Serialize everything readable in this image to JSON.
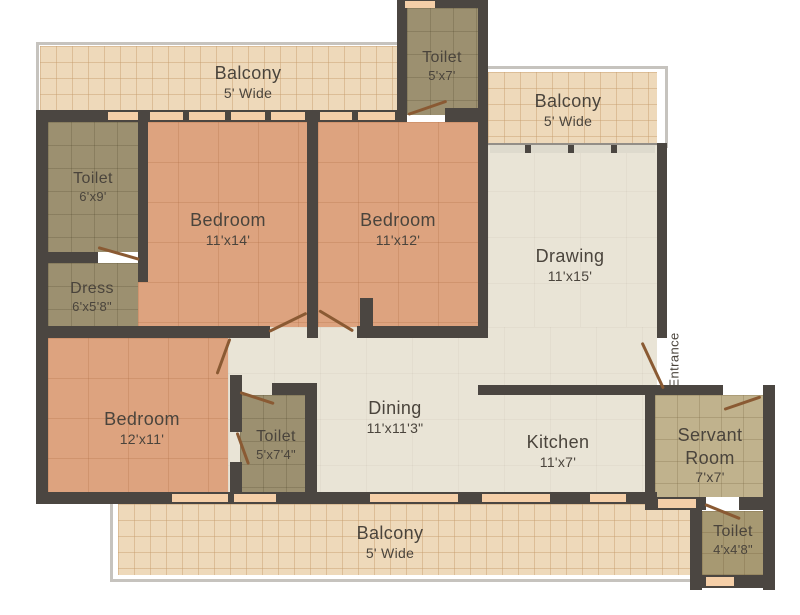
{
  "plan": {
    "type": "apartment-floor-plan",
    "rooms": {
      "balcony_top": {
        "name": "Balcony",
        "dims": "5' Wide"
      },
      "toilet_top": {
        "name": "Toilet",
        "dims": "5'x7'"
      },
      "balcony_right": {
        "name": "Balcony",
        "dims": "5' Wide"
      },
      "toilet_left": {
        "name": "Toilet",
        "dims": "6'x9'"
      },
      "dress": {
        "name": "Dress",
        "dims": "6'x5'8\""
      },
      "bedroom_master": {
        "name": "Bedroom",
        "dims": "11'x14'"
      },
      "bedroom_second": {
        "name": "Bedroom",
        "dims": "11'x12'"
      },
      "drawing": {
        "name": "Drawing",
        "dims": "11'x15'"
      },
      "bedroom_third": {
        "name": "Bedroom",
        "dims": "12'x11'"
      },
      "toilet_common": {
        "name": "Toilet",
        "dims": "5'x7'4\""
      },
      "dining": {
        "name": "Dining",
        "dims": "11'x11'3\""
      },
      "kitchen": {
        "name": "Kitchen",
        "dims": "11'x7'"
      },
      "servant_room": {
        "name": "Servant Room",
        "dims": "7'x7'"
      },
      "toilet_servant": {
        "name": "Toilet",
        "dims": "4'x4'8\""
      },
      "balcony_bottom": {
        "name": "Balcony",
        "dims": "5' Wide"
      }
    },
    "entrance_label": "Entrance",
    "colors": {
      "wall": "#4b4641",
      "bedroom_floor": "#dda37f",
      "living_floor": "#e9e4d6",
      "toilet_floor": "#9c9070",
      "servant_floor": "#c0b28d",
      "servant_toilet_floor": "#a79972",
      "balcony_floor": "#eed9ba",
      "window_sill": "#f5cfa8",
      "door": "#8a5a33",
      "label_text": "#4a443c",
      "frame": "#c6c3be"
    }
  }
}
